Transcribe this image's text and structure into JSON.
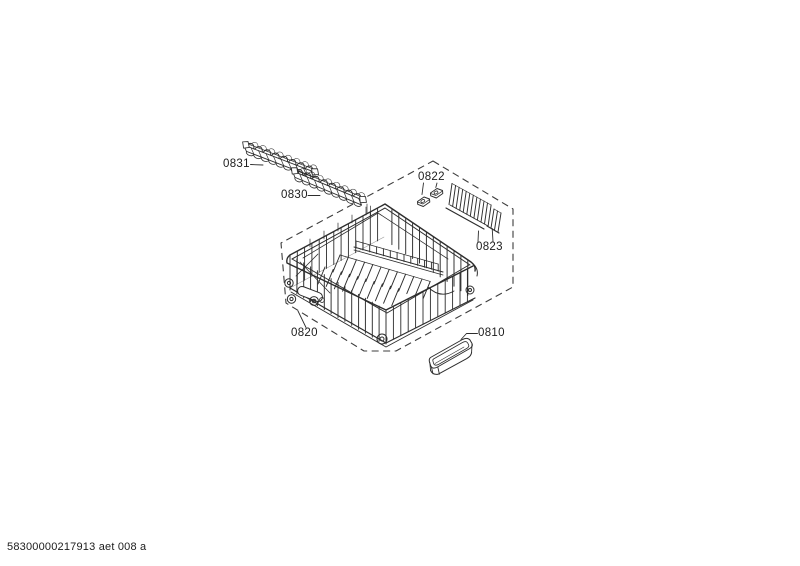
{
  "page": {
    "background": "#ffffff",
    "footer_code": "58300000217913 aet 008 a"
  },
  "diagram": {
    "line_color": "#2d2d2d",
    "boundary_color": "#3c3c3c",
    "parts": [
      {
        "label": "0831"
      },
      {
        "label": "0830"
      },
      {
        "label": "0822"
      },
      {
        "label": "0823"
      },
      {
        "label": "0820"
      },
      {
        "label": "0810"
      }
    ]
  }
}
